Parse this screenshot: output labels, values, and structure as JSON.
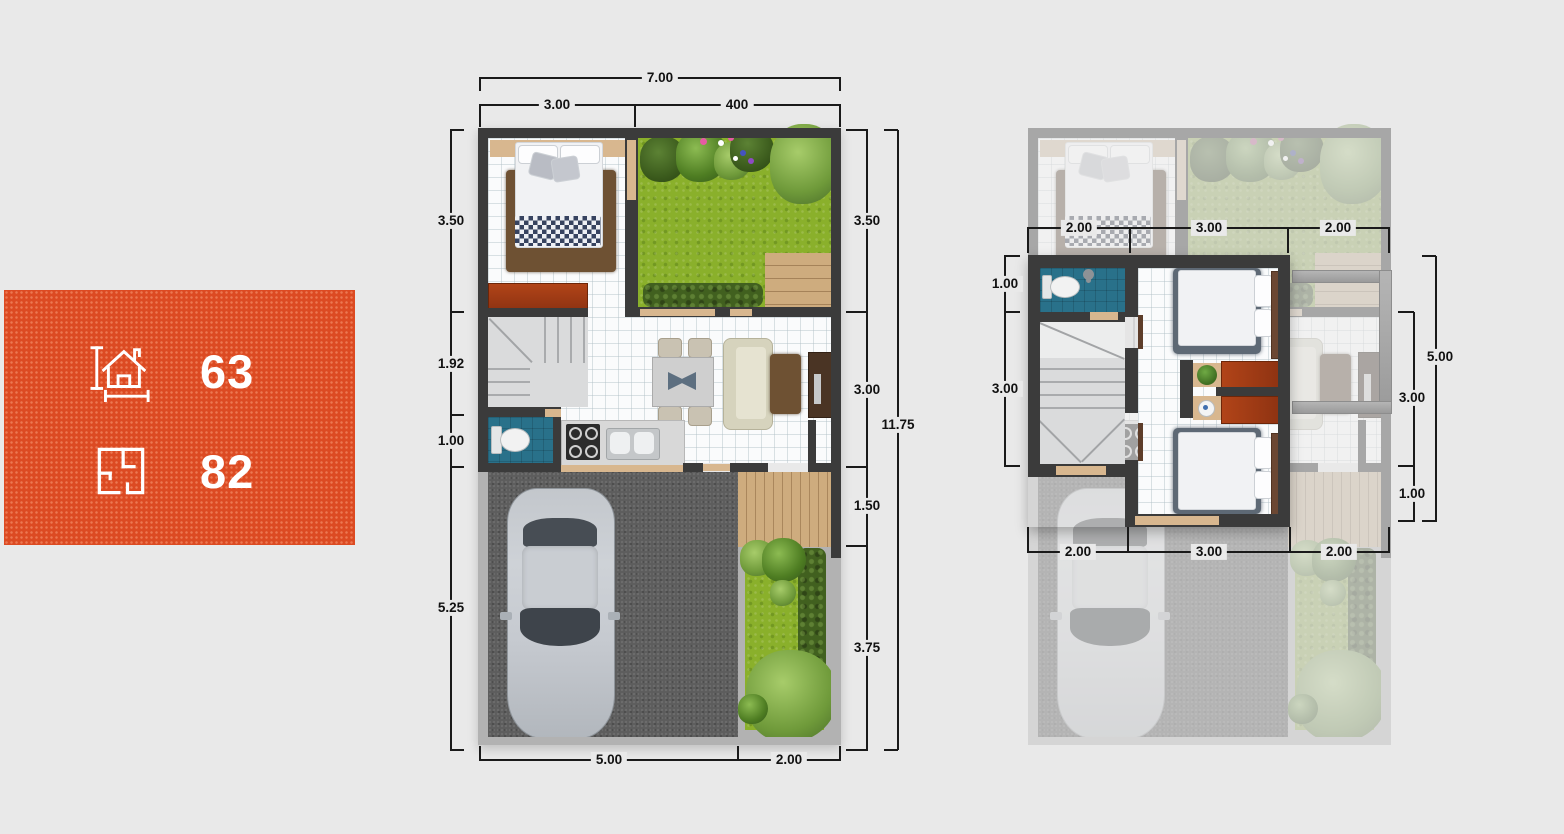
{
  "info_box": {
    "bg_color": "#dc4a22",
    "items": [
      {
        "icon": "house-dimensions-icon",
        "value": "63"
      },
      {
        "icon": "floor-plan-icon",
        "value": "82"
      }
    ]
  },
  "floor1": {
    "label": "ground-floor-plan",
    "dims": {
      "top_total": "7.00",
      "top": [
        "3.00",
        "400"
      ],
      "left": [
        "3.50",
        "1.92",
        "1.00",
        "5.25"
      ],
      "right": [
        "3.50",
        "3.00",
        "1.50",
        "3.75"
      ],
      "right_total": "11.75",
      "bottom": [
        "5.00",
        "2.00"
      ]
    }
  },
  "floor2": {
    "label": "second-floor-plan",
    "dims": {
      "top": [
        "2.00",
        "3.00",
        "2.00"
      ],
      "left": [
        "1.00",
        "3.00"
      ],
      "right": [
        "3.00",
        "1.00"
      ],
      "right_total": "5.00",
      "bottom": [
        "2.00",
        "3.00",
        "2.00"
      ]
    }
  },
  "colors": {
    "page_bg": "#e9e9e9",
    "accent_orange": "#dc4a22",
    "wall_dark": "#3b3b3b",
    "bathroom_teal": "#29718a",
    "grass_green": "#8ab02b"
  }
}
